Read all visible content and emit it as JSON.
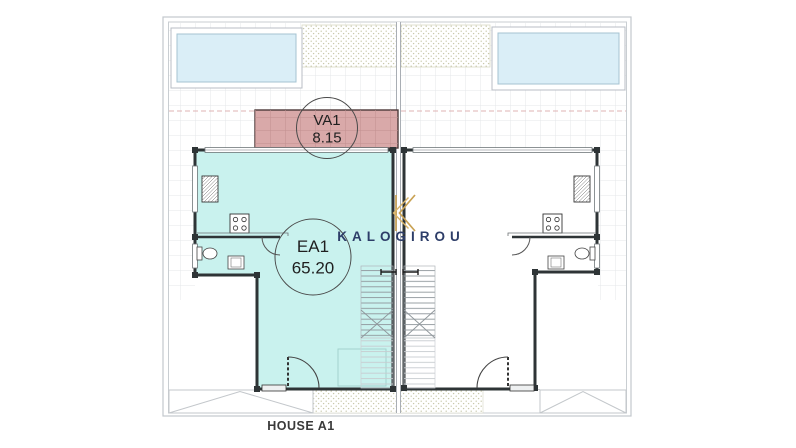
{
  "brand": {
    "name": "KALOGIROU",
    "logo_icon": "k-monogram-icon",
    "name_color": "#2d3d68",
    "logo_color": "#c9a254"
  },
  "floor_plan": {
    "house_label": "HOUSE A1",
    "rooms": [
      {
        "code": "VA1",
        "area": "8.15",
        "kind": "covered-veranda",
        "fill": "#d9a9a9"
      },
      {
        "code": "EA1",
        "area": "65.20",
        "kind": "enclosed-living-area",
        "fill": "#c9f2ee"
      }
    ],
    "pool_fill": "#daeef7",
    "wall_color": "#2e3436"
  }
}
